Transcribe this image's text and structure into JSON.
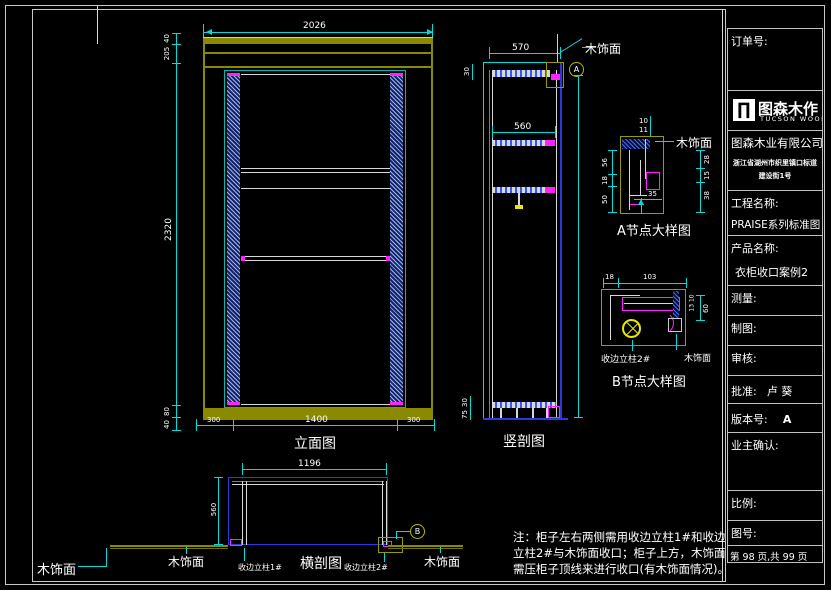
{
  "title_block": {
    "order_label": "订单号:",
    "logo": {
      "glyph": "∏",
      "cn": "图森木作",
      "en": "TUCSON WOOD"
    },
    "company": "图森木业有限公司",
    "address1": "浙江省湖州市织里镇口标道",
    "address2": "建设街1号",
    "project_label": "工程名称:",
    "project_value": "PRAISE系列标准图",
    "product_label": "产品名称:",
    "product_value": "衣柜收口案例2",
    "measure_label": "测量:",
    "draft_label": "制图:",
    "review_label": "审核:",
    "approve_label": "批准:",
    "approve_value": "卢  葵",
    "version_label": "版本号:",
    "version_value": "A",
    "owner_label": "业主确认:",
    "scale_label": "比例:",
    "figno_label": "图号:",
    "page_info": "第 98 页,共 99 页"
  },
  "elevation": {
    "title": "立面图",
    "dim_top": "2026",
    "left_dims": [
      "40",
      "205",
      "2320",
      "80",
      "40"
    ],
    "bottom_dims": [
      "300",
      "1400",
      "300"
    ]
  },
  "vsection": {
    "title": "竖剖图",
    "dim_top": "570",
    "dim_shelf": "560",
    "dim_left_top": "30",
    "dim_bottom_a": "30",
    "dim_bottom_b": "75",
    "veneer": "木饰面",
    "bubble": "A"
  },
  "detail_a": {
    "title": "A节点大样图",
    "veneer": "木饰面",
    "d_top1": "10",
    "d_top2": "11",
    "d_left1": "56",
    "d_left2": "18",
    "d_left3": "50",
    "d_right1": "28",
    "d_right2": "15",
    "d_right3": "38",
    "d_bottom": "35"
  },
  "detail_b": {
    "title": "B节点大样图",
    "veneer": "木饰面",
    "post": "收边立柱2#",
    "d_top": "103",
    "d_top_left": "18",
    "d_right": "60",
    "d_inner": "13 10"
  },
  "plan": {
    "title": "横剖图",
    "dim_top": "1196",
    "dim_left": "560",
    "veneer_far_left": "木饰面",
    "veneer_left": "木饰面",
    "veneer_right": "木饰面",
    "post1": "收边立柱1#",
    "post2": "收边立柱2#",
    "bubble": "B"
  },
  "notes": {
    "line1": "注：柜子左右两侧需用收边立柱1#和收边",
    "line2": "立柱2#与木饰面收口；柜子上方，木饰面",
    "line3": "需压柜子顶线来进行收口(有木饰面情况)。"
  }
}
